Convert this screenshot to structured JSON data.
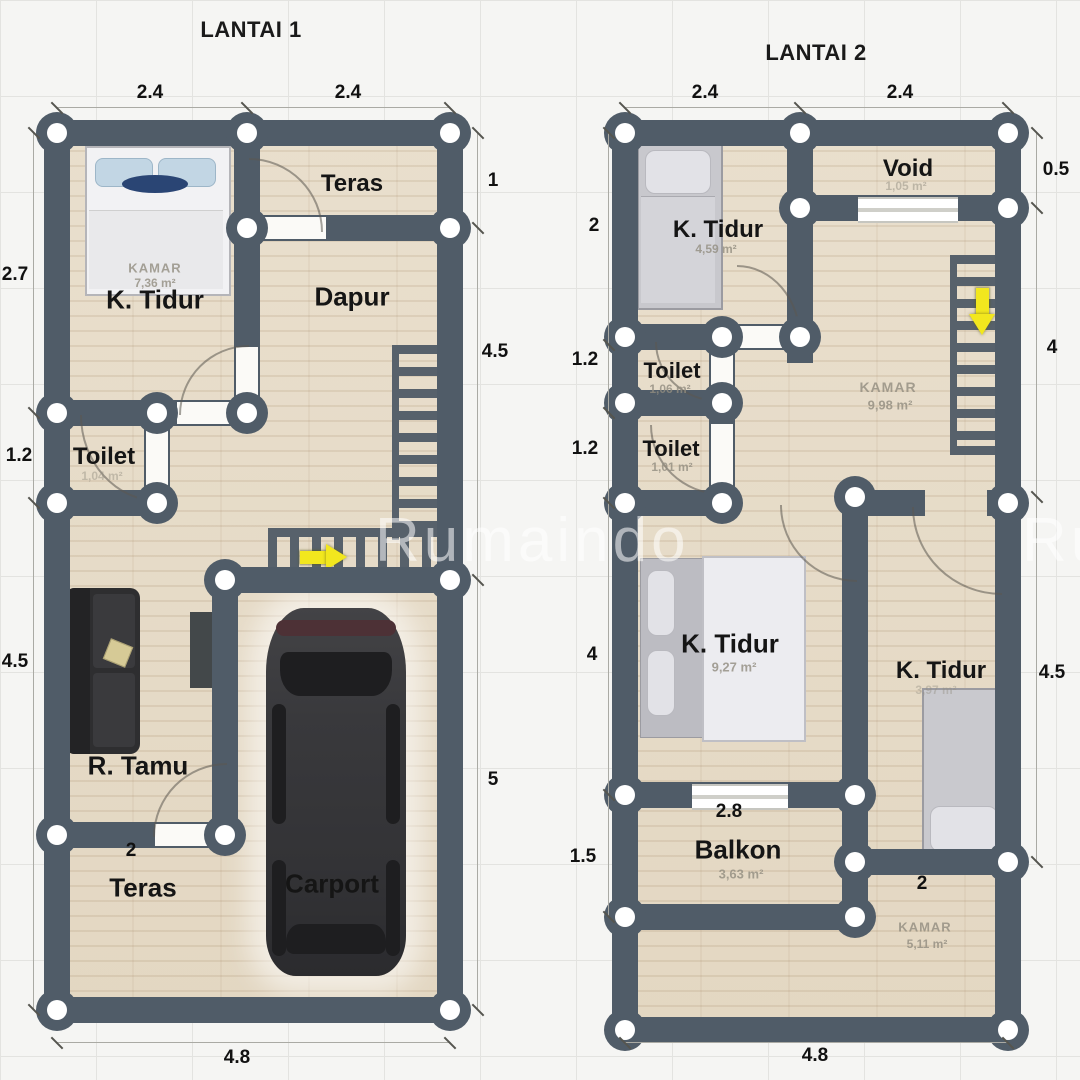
{
  "watermark": "Rumaindo",
  "plans": [
    {
      "title": "LANTAI 1",
      "rooms": {
        "teras_top": {
          "label": "Teras"
        },
        "dapur": {
          "label": "Dapur"
        },
        "k_tidur": {
          "label": "K. Tidur",
          "kamar": "KAMAR",
          "area": "7,36 m²"
        },
        "toilet": {
          "label": "Toilet",
          "area": "1,04 m²"
        },
        "r_tamu": {
          "label": "R. Tamu"
        },
        "teras_bottom": {
          "label": "Teras"
        },
        "carport": {
          "label": "Carport"
        }
      },
      "dims": {
        "top1": "2.4",
        "top2": "2.4",
        "left1": "2.7",
        "left2": "1.2",
        "left3": "4.5",
        "right1": "1",
        "right2": "4.5",
        "right3": "5",
        "bottom": "4.8",
        "door": "2"
      }
    },
    {
      "title": "LANTAI 2",
      "rooms": {
        "k_tidur_1": {
          "label": "K. Tidur",
          "area": "4,59 m²"
        },
        "void": {
          "label": "Void",
          "area": "1,05 m²"
        },
        "toilet_1": {
          "label": "Toilet",
          "area": "1,06 m²"
        },
        "toilet_2": {
          "label": "Toilet",
          "area": "1,01 m²"
        },
        "kamar_mid": {
          "kamar": "KAMAR",
          "area": "9,98 m²"
        },
        "k_tidur_2": {
          "label": "K. Tidur",
          "area": "9,27 m²"
        },
        "k_tidur_3": {
          "label": "K. Tidur",
          "area": "3,97 m²"
        },
        "balkon": {
          "label": "Balkon",
          "area": "3,63 m²"
        },
        "kamar_br": {
          "kamar": "KAMAR",
          "area": "5,11 m²"
        }
      },
      "dims": {
        "top1": "2.4",
        "top2": "2.4",
        "left1": "2",
        "left2": "1.2",
        "left3": "1.2",
        "left4": "4",
        "left5": "1.5",
        "right1": "0.5",
        "right2": "4",
        "right3": "4.5",
        "bottom": "4.8",
        "balkon_w": "2.8",
        "room_w": "2"
      }
    }
  ],
  "colors": {
    "wall": "#505c68",
    "floor": "#e6dcc8",
    "arrow": "#f2e71e",
    "dimension_text": "#111111",
    "faint_label": "#928d80"
  }
}
